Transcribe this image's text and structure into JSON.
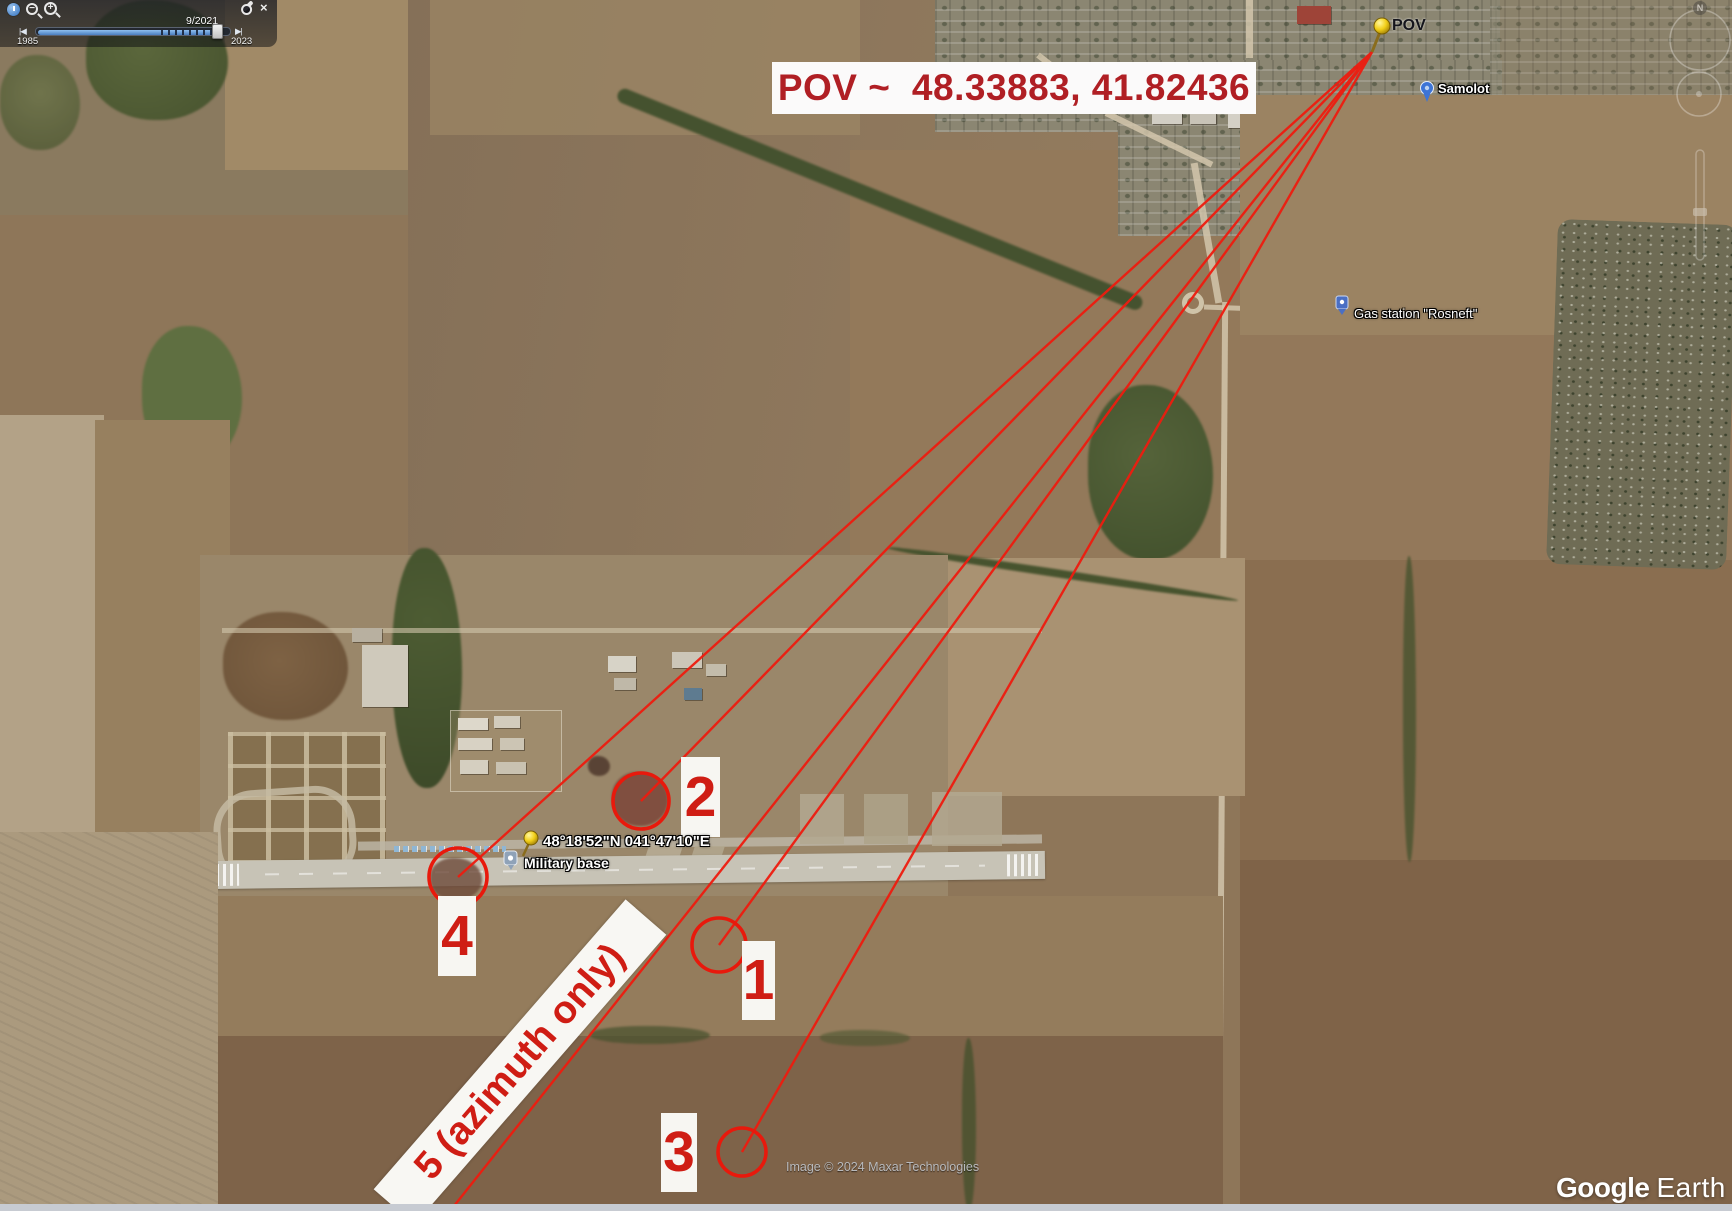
{
  "app": {
    "name": "Google Earth"
  },
  "time_slider": {
    "date_label": "9/2021",
    "range_start": "1985",
    "range_end": "2023",
    "prev_glyph": "|◀",
    "next_glyph": "▶|",
    "zoom_out_glyph": "−",
    "zoom_in_glyph": "+",
    "close_glyph": "×"
  },
  "pov": {
    "banner": "POV ~  48.33883, 41.82436",
    "pin_label": "POV",
    "latitude": "48.33883",
    "longitude": "41.82436"
  },
  "markers": [
    {
      "id": "1",
      "label": "1"
    },
    {
      "id": "2",
      "label": "2"
    },
    {
      "id": "3",
      "label": "3"
    },
    {
      "id": "4",
      "label": "4"
    },
    {
      "id": "5",
      "label": "5 (azimuth only)"
    }
  ],
  "placemarks": {
    "base_coordinates": "48°18'52\"N 041°47'10\"E",
    "base_name": "Military base",
    "samolot_label": "Samolot",
    "gas_station_label": "Gas station \"Rosneft\""
  },
  "compass": {
    "north_label": "N"
  },
  "attribution": "Image © 2024 Maxar Technologies",
  "logo": {
    "google": "Google",
    "earth": "Earth"
  },
  "colors": {
    "annotation_red": "#ee1c0f",
    "digit_red": "#cf1d14",
    "pov_text_red": "#b01f24",
    "label_box_white": "#f7f6f2",
    "pushpin_yellow": "#f2cf18",
    "attribution_gray": "#b9babd"
  }
}
